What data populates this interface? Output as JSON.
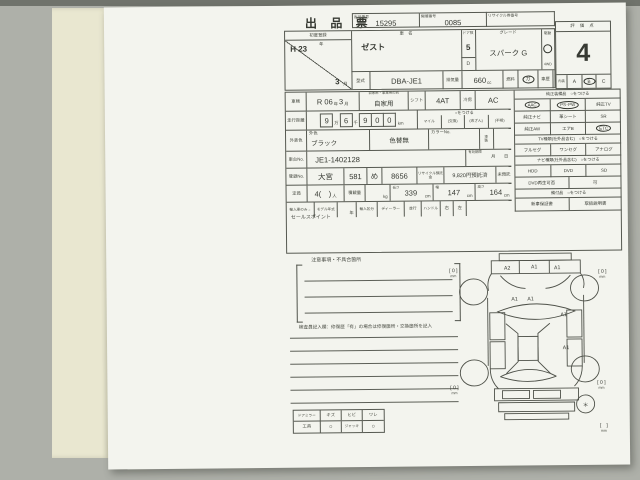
{
  "colors": {
    "background": "#aeb0a9",
    "paper": "#f3f4ee",
    "side_page": "#e9e7d0",
    "line": "#565951"
  },
  "header": {
    "title": "出 品 票",
    "boxes": [
      {
        "label": "出品番号",
        "value": "15295"
      },
      {
        "label": "開催番号",
        "value": "0085"
      },
      {
        "label": "リサイクル券番号",
        "value": ""
      }
    ]
  },
  "top": {
    "first_reg": {
      "label": "初度登録",
      "era": "H 23",
      "era_unit": "年",
      "month": "3",
      "month_unit": "月"
    },
    "car_name": {
      "label": "車　名",
      "value": "ゼスト"
    },
    "door": {
      "label": "ドア数",
      "value": "5",
      "sub": "D"
    },
    "grade": {
      "label": "グレード",
      "value": "スパーク G"
    },
    "drive": {
      "label": "駆動",
      "mark": "○",
      "value": "4WD"
    },
    "model": {
      "label": "型式",
      "value": "DBA-JE1"
    },
    "displacement": {
      "label": "排気量",
      "value": "660",
      "unit": "cc"
    },
    "fuel": {
      "label": "燃料",
      "value": "ガ"
    },
    "history": {
      "label": "車歴",
      "value": ""
    },
    "score": {
      "label": "評 価 点",
      "value": "4",
      "interior_label": "内装",
      "grade_a": "A",
      "grade_b": "B",
      "grade_c": "C",
      "circled": "B"
    }
  },
  "details": {
    "shaken": {
      "label": "車検",
      "era": "R 06",
      "era_unit": "年",
      "month": "3",
      "month_unit": "月"
    },
    "usage": {
      "label": "自家用・事業用の別",
      "value": "自家用"
    },
    "shift": {
      "label": "シフト",
      "value": "4AT"
    },
    "cooling": {
      "label": "冷房",
      "value": "AC"
    },
    "mileage": {
      "label": "走行距離",
      "d1": "9",
      "u1": "万",
      "d2": "6",
      "u2": "千",
      "d3": "9",
      "d4": "0",
      "d5": "0",
      "unit": "km",
      "mark_header": "○をつける",
      "marks": [
        "マイル",
        "(交換)",
        "(改ざん)",
        "(不明)"
      ]
    },
    "color": {
      "label": "外装色",
      "sub": "外色",
      "value": "ブラック",
      "change": "色替無",
      "color_no_label": "カラーNo.",
      "paint": "塗装"
    },
    "chassis": {
      "label": "車台No.",
      "value": "JE1-1402128",
      "expiry_label": "有効期限",
      "expiry": "月　　日"
    },
    "registration": {
      "label": "登録No.",
      "area": "大宮",
      "class": "581",
      "kana": "め",
      "number": "8656",
      "recycle_label": "リサイクル預託金",
      "recycle_value": "9,820円預託済",
      "recycle_none": "未預託"
    },
    "capacity": {
      "label": "定員",
      "value": "4(　)",
      "unit": "人",
      "load_label": "積載量",
      "load_unit": "kg",
      "len_label": "長さ",
      "len": "339",
      "len_unit": "cm",
      "wid_label": "幅",
      "wid": "147",
      "wid_unit": "cm",
      "hei_label": "高さ",
      "hei": "164",
      "hei_unit": "cm"
    },
    "import": {
      "label": "輸入車のみ→",
      "model_year": "モデル年式",
      "year_unit": "年",
      "division": "輸入区分",
      "dealer": "ディーラー",
      "parallel": "並行",
      "handle": "ハンドル",
      "right": "右",
      "left": "左"
    },
    "sales_point": {
      "label": "セールスポイント"
    }
  },
  "equipment": {
    "equip_header": "純正装備品　○をつける",
    "equip_cells": [
      [
        "AAC",
        "PS･PW",
        "純正TV"
      ],
      [
        "純正ナビ",
        "革シート",
        "SR"
      ],
      [
        "純正AW",
        "エアB",
        "ETC"
      ]
    ],
    "equip_circled": [
      "AAC",
      "PS･PW",
      "ETC"
    ],
    "tv_header": "TV種類(社外品含む)　○をつける",
    "tv_cells": [
      "フルセグ",
      "ワンセグ",
      "アナログ"
    ],
    "navi_header": "ナビ種類(社外品含む)　○をつける",
    "navi_cells": [
      "HDD",
      "DVD",
      "SD"
    ],
    "dvd_label": "DVD再生可否",
    "dvd_value": "可",
    "docs_header": "備付品　○をつける",
    "docs_cells": [
      "新車保証書",
      "取扱説明書"
    ]
  },
  "bottom": {
    "notes_label": "注意事項・不具合箇所",
    "inspector_label": "検査員記入欄：修復歴「有」の場合は修復箇所・交換箇所を記入",
    "mirror_table": {
      "headers": [
        "ドアミラー",
        "キズ",
        "ヒビ",
        "ワレ"
      ],
      "row": [
        "工具",
        "○",
        "ジャッキ",
        "○"
      ]
    },
    "diagram": {
      "front_marks": [
        "A2",
        "A1",
        "A1"
      ],
      "hood_marks": [
        "A1",
        "A1"
      ],
      "side_marks": [
        "A1",
        "A1"
      ],
      "tread_value": "[ 0 ]",
      "tread_unit": "mm",
      "spare_mark": "＊",
      "spare_tread": "[　]"
    }
  }
}
